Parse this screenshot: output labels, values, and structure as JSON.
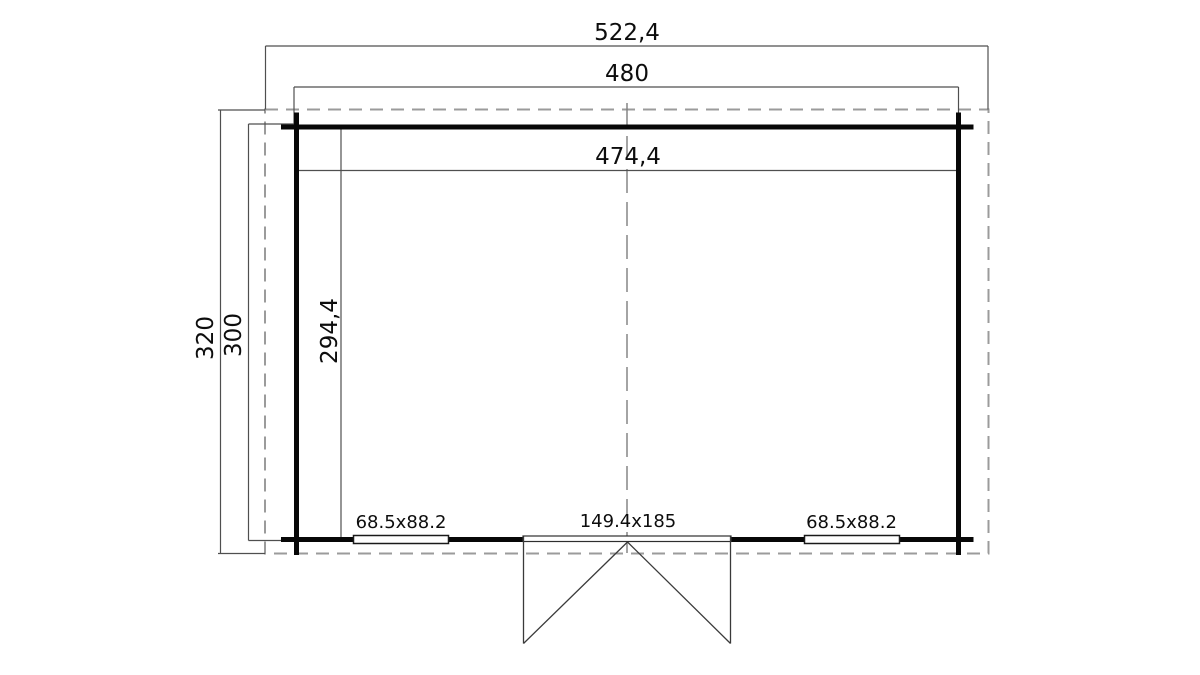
{
  "drawing": {
    "type": "garden-house-floor-plan",
    "colors": {
      "wall": "#070707",
      "dimension_line": "#4f4f4f",
      "dashed_outline": "#9b9b9b",
      "text": "#0d0d0d",
      "background": "#ffffff"
    },
    "dimensions": {
      "overall_width": "522,4",
      "wall_width": "480",
      "interior_width": "474,4",
      "overall_depth": "320",
      "wall_depth": "300",
      "interior_depth": "294,4"
    },
    "openings": {
      "window_left": "68.5x88.2",
      "door": "149.4x185",
      "window_right": "68.5x88.2"
    }
  }
}
